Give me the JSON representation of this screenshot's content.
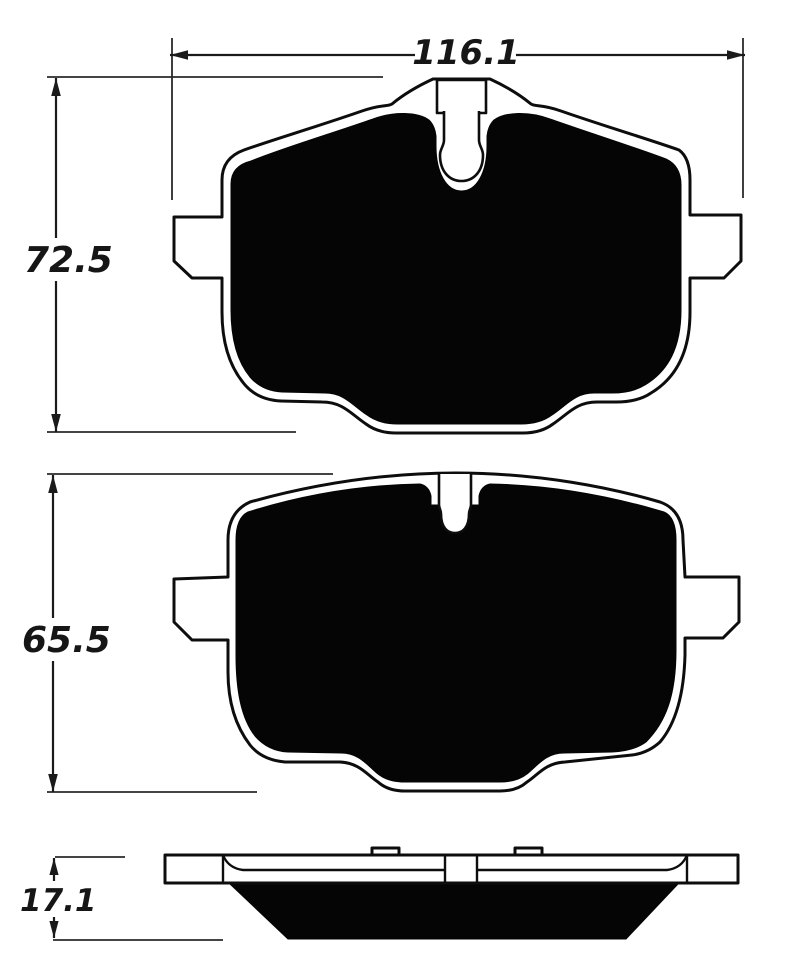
{
  "dimensions": {
    "width_top": {
      "label": "116.1"
    },
    "height_top_pad": {
      "label": "72.5"
    },
    "height_middle_pad": {
      "label": "65.5"
    },
    "thickness_side_view": {
      "label": "17.1"
    }
  },
  "colors": {
    "line": "#0d0d0d",
    "friction_fill": "#050505",
    "background": "#ffffff"
  }
}
